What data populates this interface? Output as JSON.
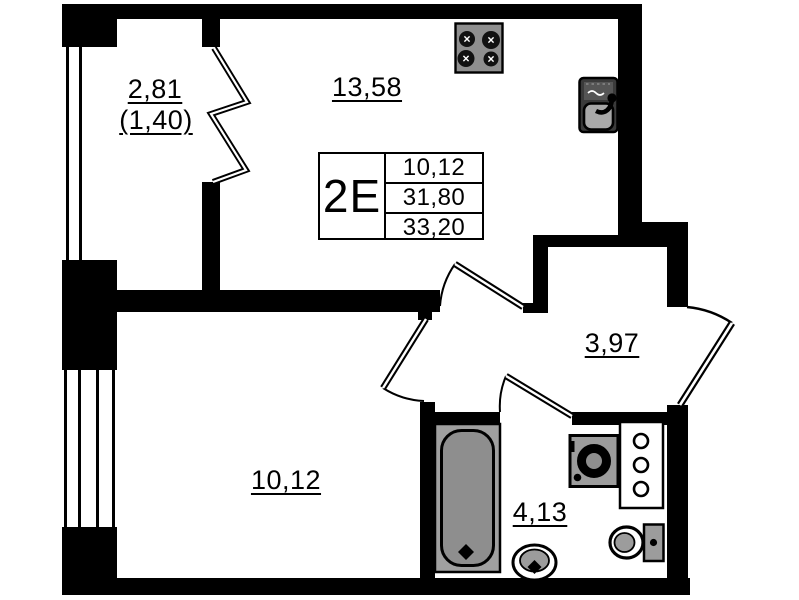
{
  "colors": {
    "wall": "#000000",
    "background": "#ffffff",
    "fixture_gray": "#9c9c9c"
  },
  "info_table": {
    "unit_type": "2E",
    "values": [
      "10,12",
      "31,80",
      "33,20"
    ]
  },
  "rooms": {
    "balcony": {
      "area": "2,81",
      "area_reduced": "(1,40)"
    },
    "kitchen_living": {
      "area": "13,58"
    },
    "hallway": {
      "area": "3,97"
    },
    "bedroom": {
      "area": "10,12"
    },
    "bathroom": {
      "area": "4,13"
    }
  }
}
